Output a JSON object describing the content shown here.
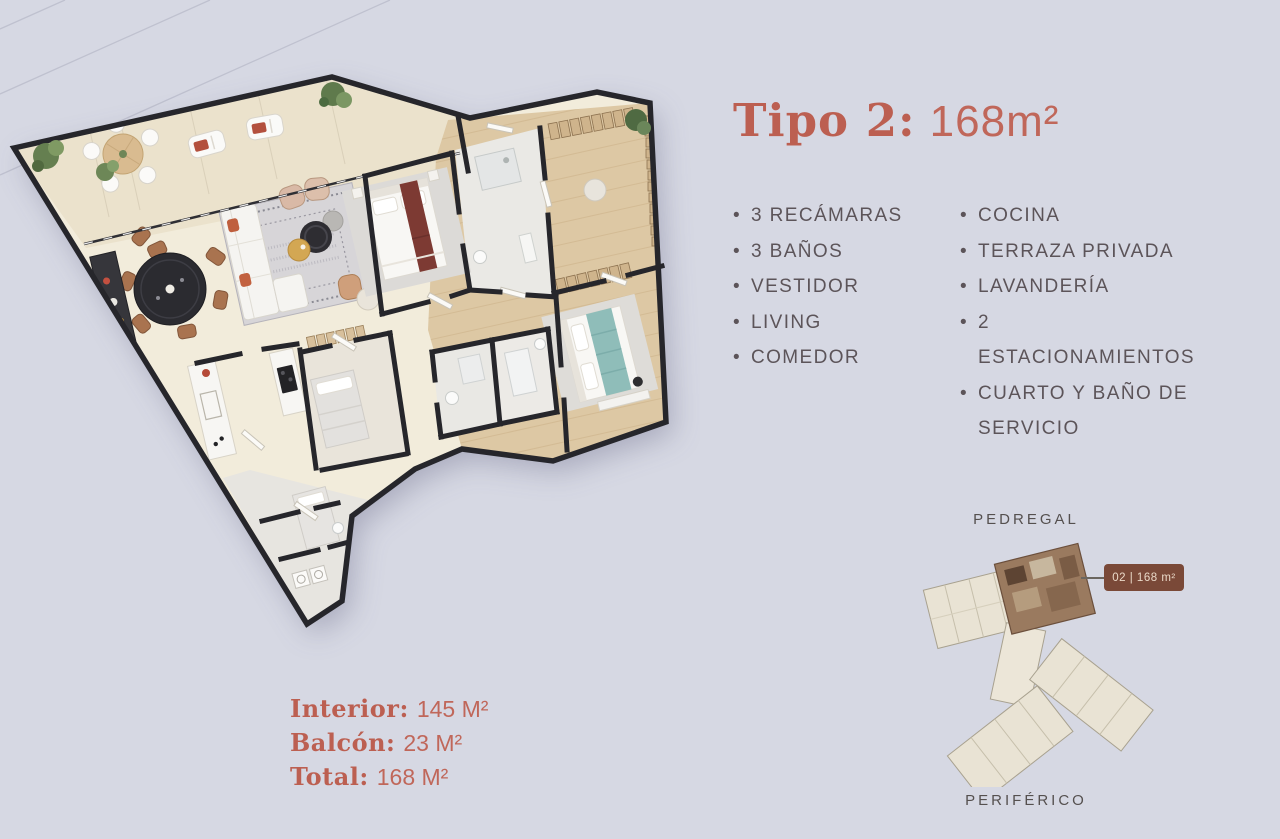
{
  "title": {
    "name": "Tipo 2:",
    "area": "168m²"
  },
  "features": {
    "bullet": "•",
    "left": [
      "3 RECÁMARAS",
      "3 BAÑOS",
      "VESTIDOR",
      "LIVING",
      "COMEDOR"
    ],
    "right": [
      "COCINA",
      "TERRAZA PRIVADA",
      "LAVANDERÍA",
      "2 ESTACIONAMIENTOS",
      "CUARTO Y BAÑO DE SERVICIO"
    ]
  },
  "stats": {
    "items": [
      {
        "label": "Interior:",
        "value": "145 M²"
      },
      {
        "label": "Balcón:",
        "value": "23 M²"
      },
      {
        "label": "Total:",
        "value": "168 M²"
      }
    ]
  },
  "minimap": {
    "top_label": "PEDREGAL",
    "bottom_label": "PERIFÉRICO",
    "badge": "02 | 168 m²"
  },
  "colors": {
    "background": "#d6d8e3",
    "accent": "#bc5f51",
    "feature_text": "#5c5459",
    "badge_bg": "#7a4938"
  }
}
